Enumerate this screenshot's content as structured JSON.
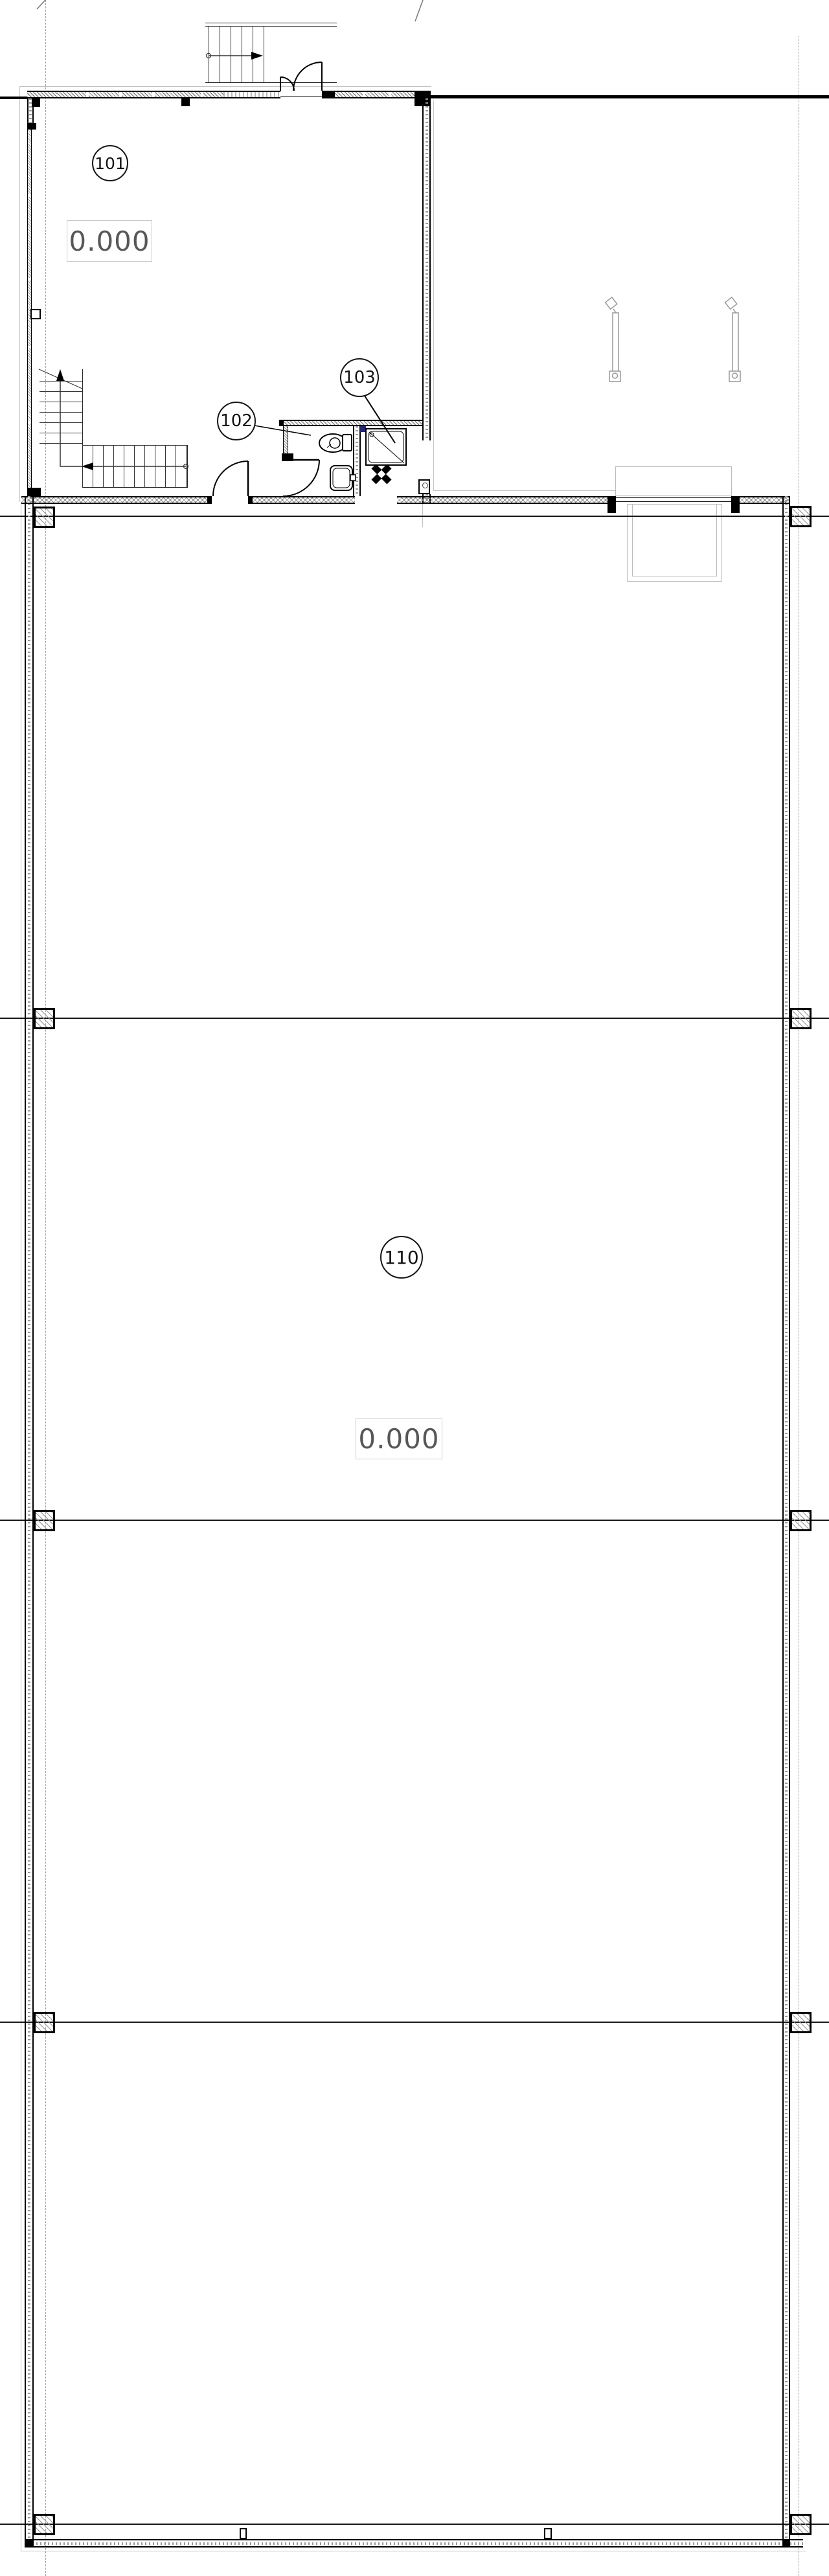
{
  "drawing_title": "ground-floor-plan",
  "rooms": [
    {
      "number": "101",
      "level": "0.000"
    },
    {
      "number": "102"
    },
    {
      "number": "103"
    },
    {
      "number": "110",
      "level": "0.000"
    }
  ],
  "colors": {
    "line": "#161616",
    "accent_navy": "#26266e",
    "muted_text": "#575757",
    "guide_gray": "#9f9f9f",
    "fixture_gray": "#999999"
  }
}
